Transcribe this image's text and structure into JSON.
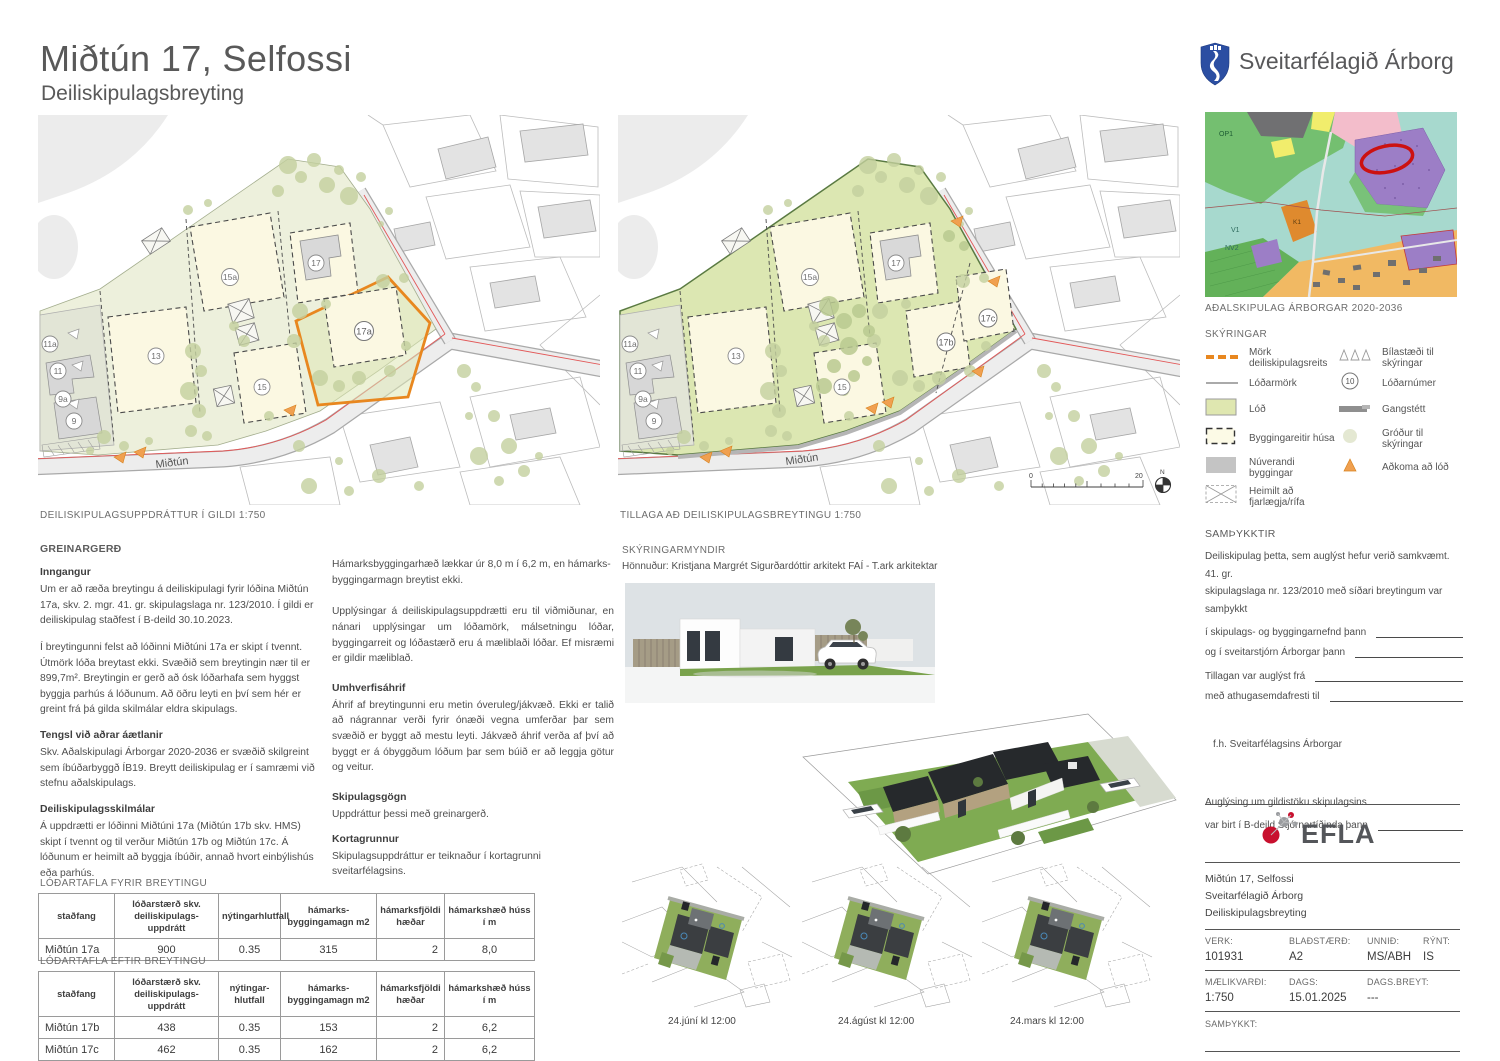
{
  "header": {
    "title": "Miðtún 17, Selfossi",
    "subtitle": "Deiliskipulagsbreyting",
    "municipality": "Sveitarfélagið Árborg"
  },
  "maps": {
    "left": {
      "caption": "DEILISKIPULAGSUPPDRÁTTUR Í GILDI  1:750",
      "street": "Miðtún",
      "lots": [
        "11a",
        "11",
        "9a",
        "9",
        "13",
        "15a",
        "15",
        "17",
        "17a"
      ]
    },
    "right": {
      "caption": "TILLAGA AÐ DEILISKIPULAGSBREYTINGU 1:750",
      "street": "Miðtún",
      "lots": [
        "11a",
        "11",
        "9a",
        "9",
        "13",
        "15a",
        "15",
        "17",
        "17b",
        "17c"
      ],
      "scale_start": "0",
      "scale_end": "20",
      "north": "N"
    },
    "master": {
      "caption": "AÐALSKIPULAG ÁRBORGAR 2020-2036",
      "labels": [
        "OP1",
        "V1",
        "NV2",
        "K1"
      ]
    }
  },
  "legend": {
    "title": "SKÝRINGAR",
    "items_left": [
      "Mörk deiliskipulagsreits",
      "Lóðarmörk",
      "Lóð",
      "Byggingareitir húsa",
      "Núverandi byggingar",
      "Heimilt að fjarlægja/rífa"
    ],
    "items_right": [
      "Bílastæði til skýringar",
      "Lóðarnúmer",
      "Gangstétt",
      "Gróður til skýringar",
      "Aðkoma að lóð"
    ],
    "lot_number_sample": "10"
  },
  "report": {
    "title": "GREINARGERÐ",
    "h1": "Inngangur",
    "p1": "Um er að ræða breytingu á deiliskipulagi fyrir lóðina Miðtún 17a, skv. 2. mgr. 41. gr. skipulagslaga nr. 123/2010. Í gildi er deiliskipulag staðfest í B-deild 30.10.2023.",
    "p2": "Í  breytingunni felst að lóðinni Miðtúni 17a er skipt í tvennt. Útmörk lóða breytast ekki. Svæðið sem breytingin nær til er 899,7m². Breytingin er gerð að ósk lóðarhafa sem hyggst byggja parhús á lóðunum. Að öðru leyti en því sem hér er greint frá þá gilda skilmálar eldra skipulags.",
    "h2": "Tengsl við aðrar áætlanir",
    "p3": "Skv. Aðalskipulagi Árborgar 2020-2036 er svæðið skilgreint sem íbúðarbyggð ÍB19. Breytt deiliskipulag er í samræmi við stefnu aðalskipulags.",
    "h3": "Deiliskipulagsskilmálar",
    "p4": "Á uppdrætti er lóðinni Miðtúni 17a (Miðtún 17b skv. HMS) skipt í tvennt og til verður Miðtún 17b og Miðtún 17c. Á lóðunum er heimilt að byggja íbúðir, annað hvort einbýlishús eða parhús.",
    "p5": "Hámarksbyggingarhæð lækkar úr 8,0 m í 6,2 m, en hámarks- byggingarmagn breytist ekki.",
    "p6": "Upplýsingar á deiliskipulagsuppdrætti eru til viðmiðunar, en nánari upplýsingar um lóðamörk, málsetningu lóðar, byggingarreit og lóðastærð eru á mæliblaði lóðar. Ef misræmi er gildir mæliblað.",
    "h4": "Umhverfisáhrif",
    "p7": "Áhrif af breytingunni eru metin óveruleg/jákvæð. Ekki er talið að nágrannar verði fyrir ónæði vegna umferðar þar sem svæðið er byggt að mestu leyti. Jákvæð áhrif verða af því að byggt er á óbyggðum lóðum þar sem búið er að leggja götur og veitur.",
    "h5": "Skipulagsgögn",
    "p8": "Uppdráttur þessi með greinargerð.",
    "h6": "Kortagrunnur",
    "p9": "Skipulagsuppdráttur er teiknaður í kortagrunni sveitarfélagsins."
  },
  "tables": {
    "before": {
      "title": "LÓÐARTAFLA FYRIR BREYTINGU",
      "headers": [
        "staðfang",
        "lóðarstærð skv. deiliskipulags- uppdrátt",
        "nýtingarhlutfall",
        "hámarks- byggingamagn m2",
        "hámarksfjöldi hæðar",
        "hámarkshæð húss í m"
      ],
      "rows": [
        [
          "Miðtún 17a",
          "900",
          "0.35",
          "315",
          "2",
          "8,0"
        ]
      ]
    },
    "after": {
      "title": "LÓÐARTAFLA EFTIR BREYTINGU",
      "headers": [
        "staðfang",
        "lóðarstærð skv. deiliskipulags- uppdrátt",
        "nýtingar- hlutfall",
        "hámarks- byggingamagn m2",
        "hámarksfjöldi hæðar",
        "hámarkshæð húss í m"
      ],
      "rows": [
        [
          "Miðtún 17b",
          "438",
          "0.35",
          "153",
          "2",
          "6,2"
        ],
        [
          "Miðtún 17c",
          "462",
          "0.35",
          "162",
          "2",
          "6,2"
        ]
      ]
    }
  },
  "drawings": {
    "title": "SKÝRINGARMYNDIR",
    "credit": "Hönnuður: Kristjana Margrét Sigurðardóttir arkitekt FAÍ - T.ark arkitektar",
    "sun1": "24.júní kl 12:00",
    "sun2": "24.ágúst kl 12:00",
    "sun3": "24.mars kl 12:00"
  },
  "approvals": {
    "title": "SAMÞYKKTIR",
    "line1": "Deiliskipulag þetta, sem auglýst hefur verið samkvæmt. 41. gr.",
    "line2": "skipulagslaga nr. 123/2010 með síðari breytingum var samþykkt",
    "sig1": "í skipulags- og byggingarnefnd þann",
    "sig2": "og í sveitarstjórn Árborgar þann",
    "sig3": "Tillagan var auglýst frá",
    "sig4": "með athugasemdafresti til",
    "fh": "f.h.  Sveitarfélagsins Árborgar",
    "pub1": "Auglýsing um gildistöku skipulagsins",
    "pub2": "var birt í B-deild Stjórnartíðinda þann"
  },
  "titleblock": {
    "brand": "EFLA",
    "project_line1": "Miðtún 17, Selfossi",
    "project_line2": "Sveitarfélagið Árborg",
    "project_line3": "Deiliskipulagsbreyting",
    "verk_label": "VERK:",
    "verk": "101931",
    "bladstaerd_label": "BLAÐSTÆRÐ:",
    "bladstaerd": "A2",
    "unnid_label": "UNNIÐ:",
    "unnid": "MS/ABH",
    "rynt_label": "RÝNT:",
    "rynt": "IS",
    "maelikvardi_label": "MÆLIKVARÐI:",
    "maelikvardi": "1:750",
    "dags_label": "DAGS:",
    "dags": "15.01.2025",
    "dagsbreyt_label": "DAGS.BREYT:",
    "dagsbreyt": "---",
    "samthykkt_label": "SAMÞYKKT:"
  },
  "colors": {
    "accent_orange": "#e8871f",
    "plan_green": "#dce7b2",
    "lot_cream": "#fbf8e2",
    "existing_gray": "#d9d9d9",
    "brand_red": "#c8102e",
    "shield_blue": "#2b4ea2"
  }
}
